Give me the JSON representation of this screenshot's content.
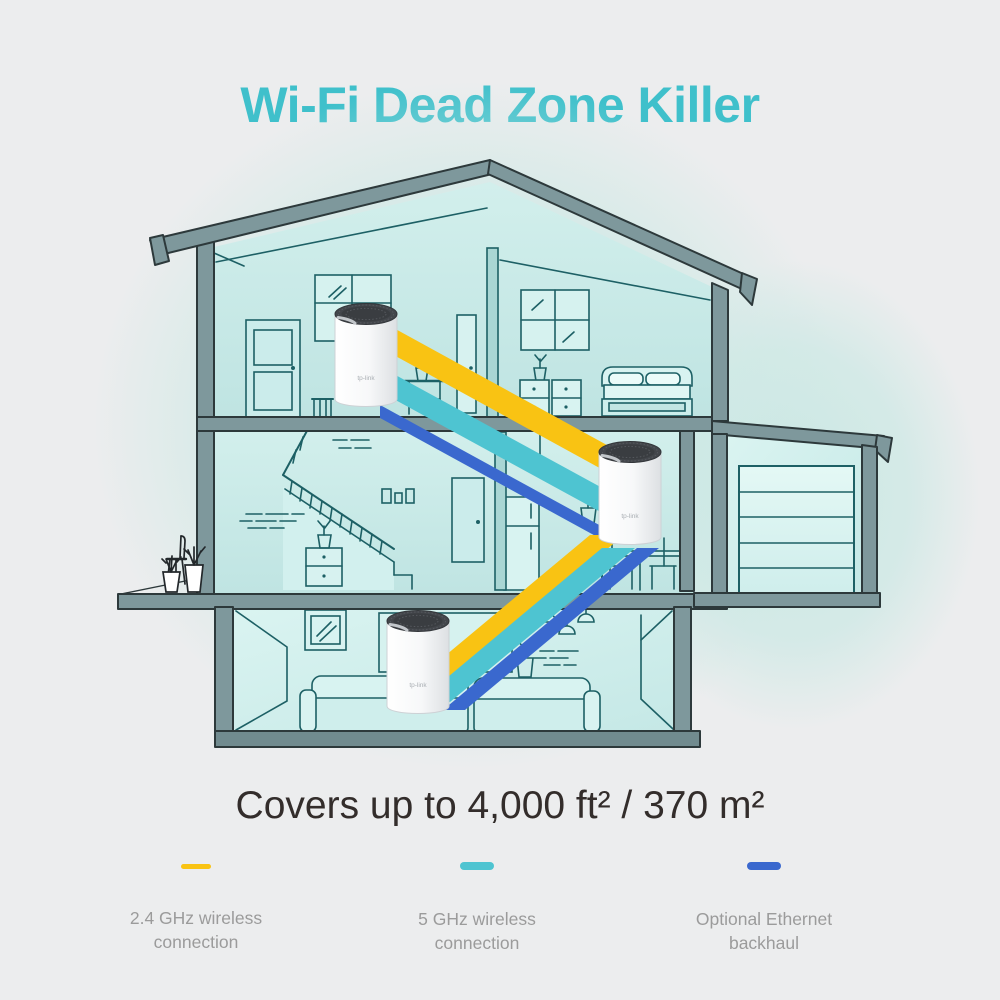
{
  "header": {
    "title": "Wi-Fi Dead Zone Killer",
    "title_color": "#3fc0cb"
  },
  "coverage": {
    "text": "Covers up to 4,000 ft² / 370 m²"
  },
  "legend": {
    "items": [
      {
        "lines": [
          "2.4 GHz wireless",
          "connection"
        ],
        "color": "#F9C313"
      },
      {
        "lines": [
          "5 GHz wireless",
          "connection"
        ],
        "color": "#4EC4D1"
      },
      {
        "lines": [
          "Optional Ethernet",
          "backhaul"
        ],
        "color": "#3A68CE"
      }
    ]
  },
  "illustration": {
    "unit_logo": "tp-link",
    "colors": {
      "band_2_4ghz": "#FBC40F",
      "band_5ghz": "#4EC4D1",
      "band_ethernet": "#3A68CE",
      "frame_gray": "#7E989C",
      "room_teal": "#C7E9E7",
      "lineart_teal": "#1D6065",
      "background_glow": "#CBE8E4",
      "unit_body": "#FFFFFF",
      "unit_cap": "#43464B"
    }
  },
  "page": {
    "background": "#ECEDEE"
  }
}
